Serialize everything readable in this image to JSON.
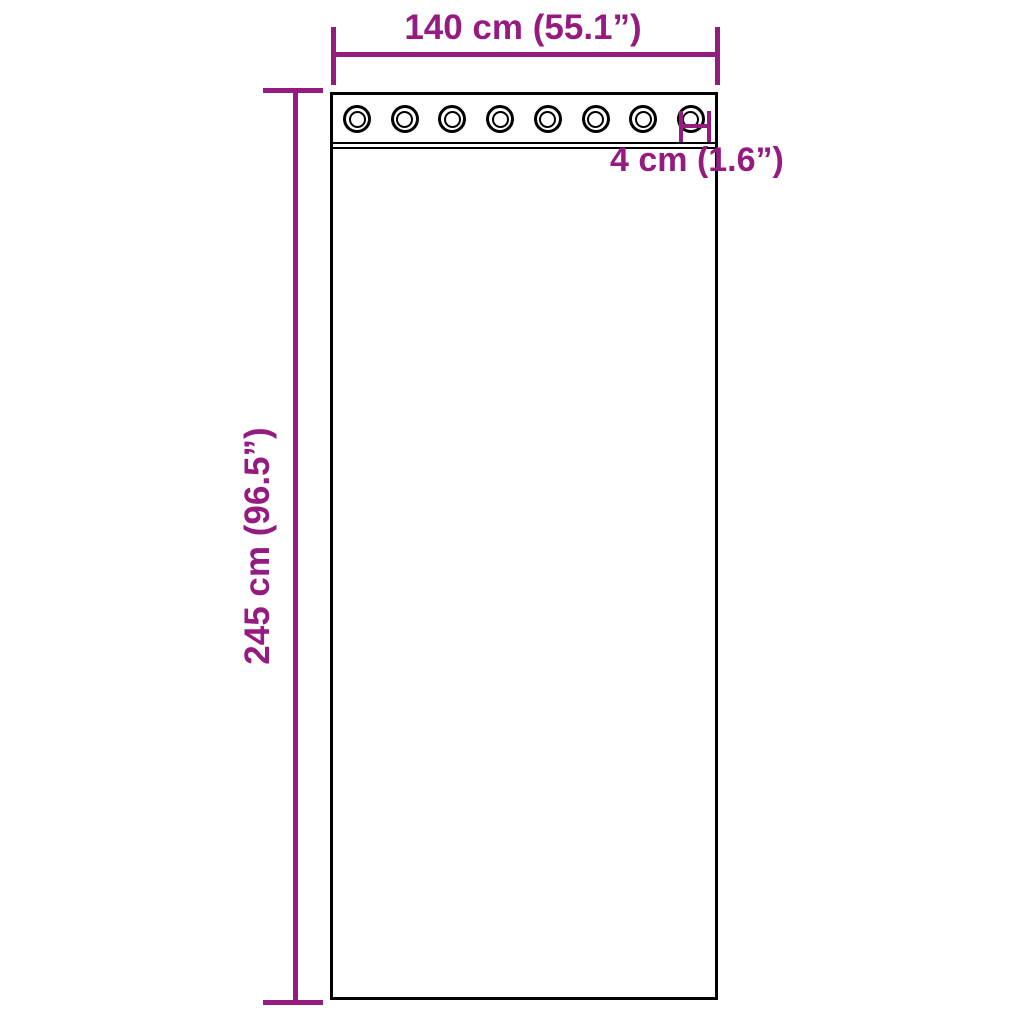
{
  "diagram": {
    "accent_color": "#951B81",
    "line_color": "#000000",
    "background_color": "#FFFFFF"
  },
  "dimensions": {
    "width": {
      "label": "140 cm (55.1”)"
    },
    "height": {
      "label": "245 cm (96.5”)"
    },
    "grommet": {
      "label": "4 cm (1.6”)"
    }
  },
  "panel": {
    "type": "curtain-panel-with-grommets",
    "grommets": {
      "count": 8
    }
  }
}
